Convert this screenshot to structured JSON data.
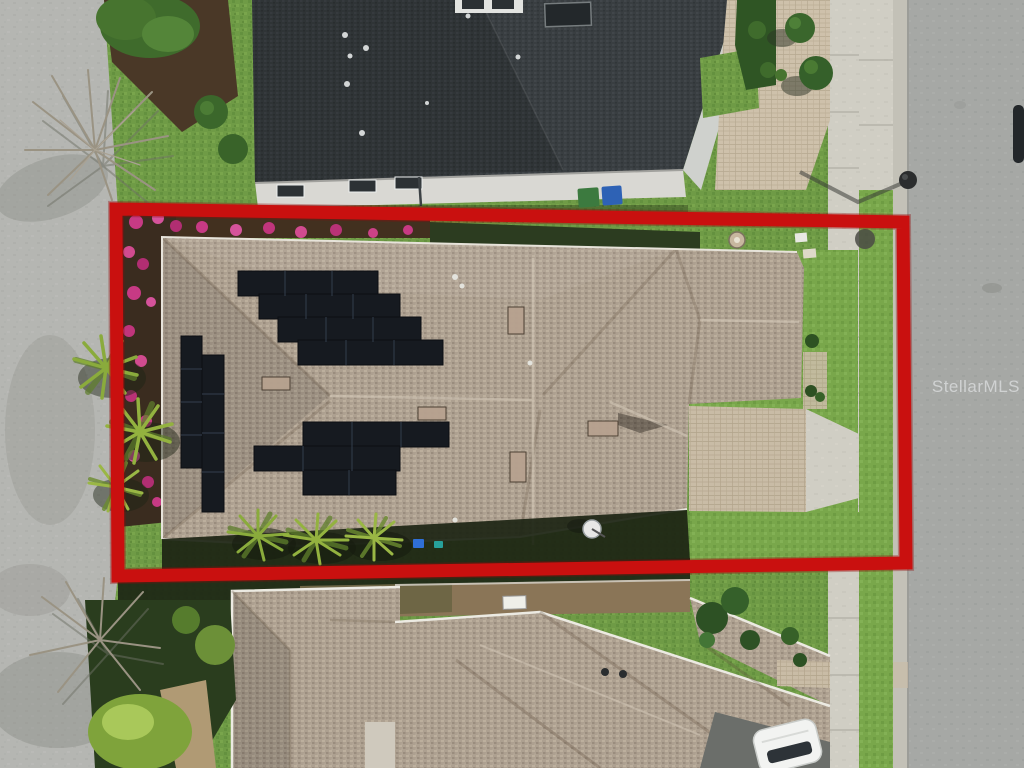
{
  "meta": {
    "type": "aerial-drone-photograph",
    "view": "top-down",
    "scene": "residential neighborhood lot highlighted for a real-estate listing"
  },
  "watermark": {
    "text": "StellarMLS"
  },
  "boundary": {
    "label": "property-lot-outline",
    "color": "#c9100f"
  },
  "features": {
    "subject_home": "tan shingle hip roof with rooftop solar arrays",
    "solar_array_groups": 3,
    "driveway": "paver driveway meeting sidewalk at right",
    "street": "asphalt street along right edge",
    "side_road": "light gray road along left edge",
    "neighbor_top": "dark charcoal shingle roof home with white wall and trash bins",
    "neighbor_bottom": "tan shingle roof homes with white car in driveway",
    "landscaping": "palms, clipped topiary, pink flowering shrubs, bare trees"
  },
  "palette": {
    "boundary_red": "#c9100f",
    "roof_tan": "#ada090",
    "roof_dark": "#393e41",
    "grass": "#6f9b46",
    "street": "#a6a8a5",
    "concrete": "#d0cec4",
    "paver": "#c9bca6",
    "solar_panel": "#161a20",
    "flower_pink": "#c73a84"
  }
}
